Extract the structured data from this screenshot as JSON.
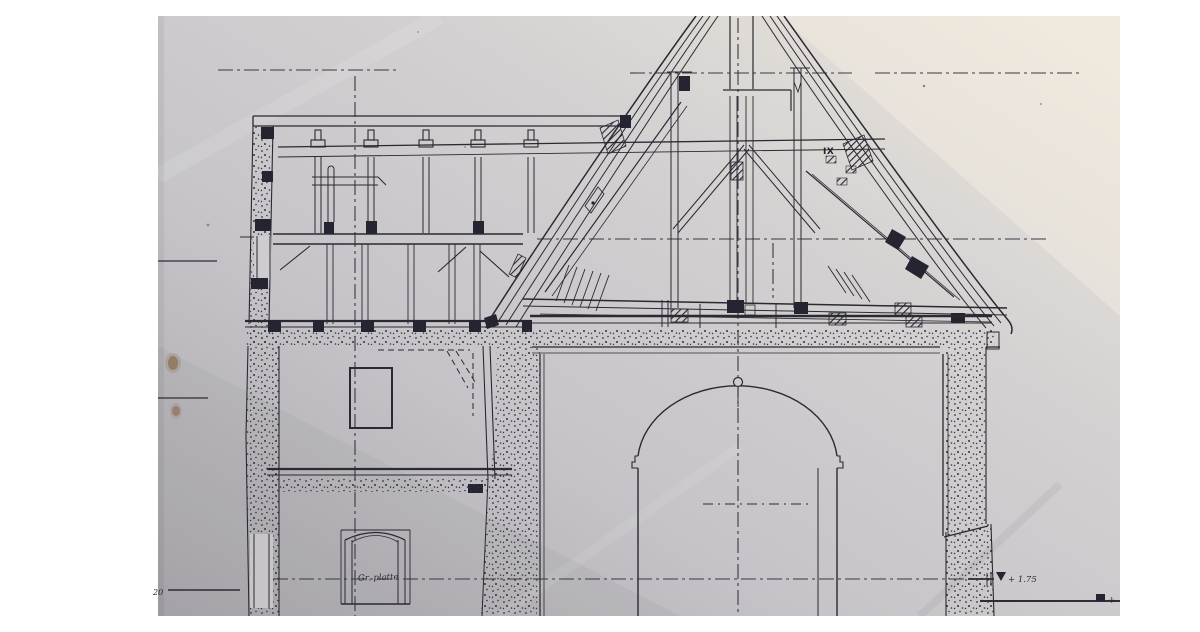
{
  "document": {
    "kind": "photograph of a hand-drawn architectural cross-section (building with attic, vaulted hall and steep spire roof truss)"
  },
  "colors": {
    "page_background": "#ffffff",
    "paper_dark_corner": "#aeacb1",
    "paper_mid": "#cbc9cd",
    "paper_light_corner": "#ede7db",
    "ink": "#2b2932",
    "stain": "#8c7055"
  },
  "annotations": {
    "truss_label": "IX",
    "window_note": "Gr. platte",
    "level_upper": "+ 1.75",
    "level_lower": "+",
    "bottom_left_note": "20"
  }
}
